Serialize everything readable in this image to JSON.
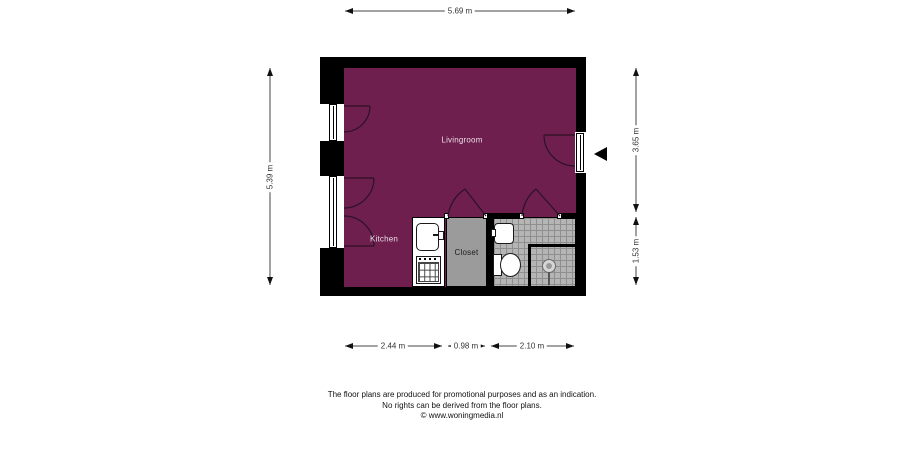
{
  "plan": {
    "room_labels": {
      "livingroom": "Livingroom",
      "kitchen": "Kitchen",
      "closet": "Closet"
    },
    "dimensions": {
      "top": "5.69 m",
      "left": "5.39 m",
      "right_upper": "3.65 m",
      "right_lower": "1.53 m",
      "bottom_kitchen": "2.44 m",
      "bottom_closet": "0.98 m",
      "bottom_bathroom": "2.10 m"
    },
    "colors": {
      "wall": "#000000",
      "floor": "#6E1F4E",
      "closet_fill": "#9B9B9B",
      "tile_fill": "#B5B5B5",
      "tile_line": "#8F8F8F"
    }
  },
  "footer": {
    "line1": "The floor plans are produced for promotional purposes and as an indication.",
    "line2": "No rights can be derived from the floor plans.",
    "line3": "© www.woningmedia.nl"
  }
}
